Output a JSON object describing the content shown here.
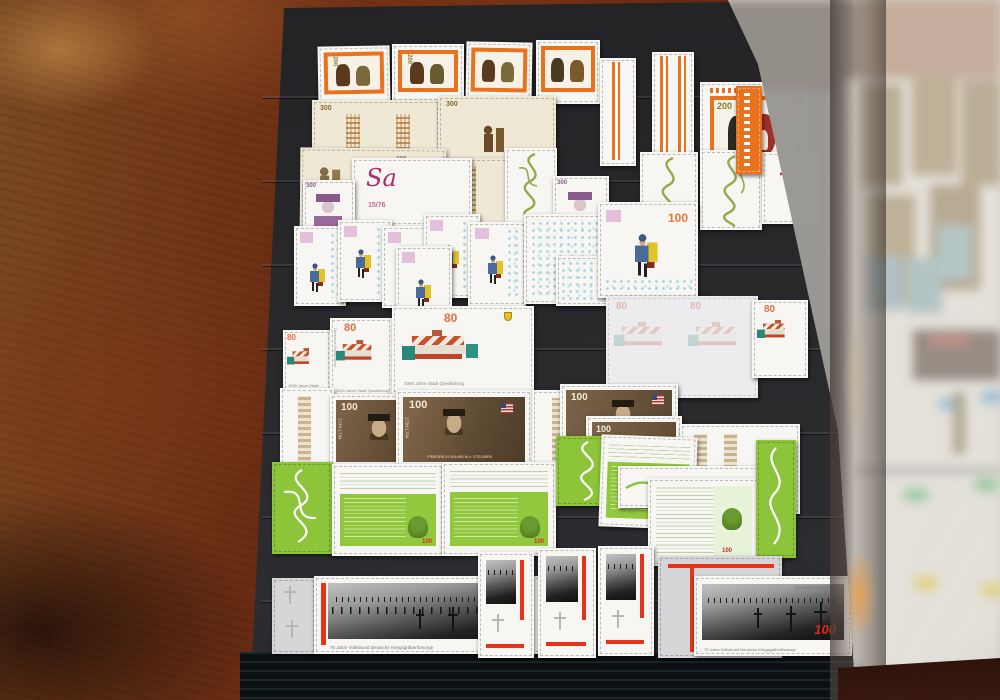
{
  "scene": {
    "description": "Photograph of an open black stockbook page of mint German stamps lying on a dark red burl-wood table; the facing page is covered by a translucent glassine interleaf",
    "left_page": "black stockbook page with clear strips holding stamp rows",
    "right_page": "stamp rows seen blurred through glassine interleaf"
  },
  "stamps": {
    "trachten": {
      "value": "200"
    },
    "lace": {
      "value": "300"
    },
    "portrait_lilac": {
      "value": "300"
    },
    "calligraphy": {
      "initial": "Sa",
      "note": "15/76"
    },
    "postman": {
      "value": "100"
    },
    "town": {
      "value": "80",
      "caption": "1000 Jahre Stadt Quedlinburg",
      "side": "Deutsche Bundespost"
    },
    "steuben": {
      "value": "100",
      "years": "1730-1794",
      "name": "FRIEDRICH WILHELM v. STEUBEN"
    },
    "manuscript": {
      "value": "100"
    },
    "war_graves": {
      "value": "100",
      "top": "Deutsche Bundespost",
      "caption": "75 Jahre Volksbund Deutsche Kriegsgräberfürsorge"
    }
  },
  "colors": {
    "wood": "#6b2d13",
    "page_black": "#29292c",
    "stamp_orange": "#e8721e",
    "manuscript_green": "#8cc43a",
    "steuben_sepia": "#6f5a40",
    "accent_red": "#e73418",
    "glassine": "#dbd7cf",
    "numeral_orange": "#e07838"
  }
}
